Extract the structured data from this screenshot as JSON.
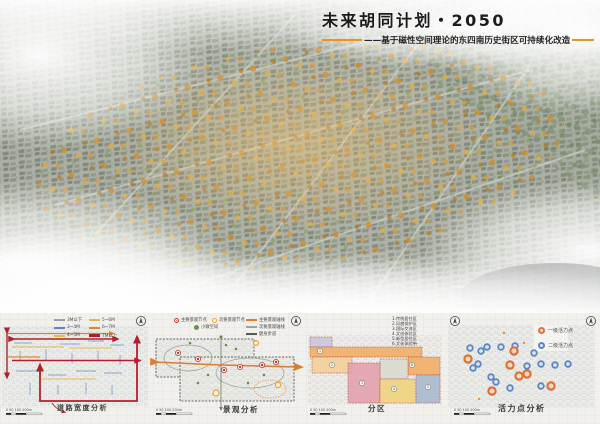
{
  "header": {
    "title": "未来胡同计划・2050",
    "subtitle": "——基于磁性空间理论的东四南历史街区可持续化改造",
    "accent_color": "#e8942c"
  },
  "aerial": {
    "caption": "鸟瞰图"
  },
  "icons": {
    "north_arrow": "north-arrow"
  },
  "panels": {
    "road": {
      "title": "道路宽度分析",
      "legend": [
        {
          "label": "3M以下",
          "color": "#9aa0a6"
        },
        {
          "label": "3~4M",
          "color": "#5b87c5"
        },
        {
          "label": "4~5M",
          "color": "#e4bd4e"
        },
        {
          "label": "5~6M",
          "color": "#f0b15c"
        },
        {
          "label": "6~7M",
          "color": "#e2842e"
        },
        {
          "label": "7M以上",
          "color": "#a32430"
        }
      ],
      "scale_label": "0 50 100   200m"
    },
    "landscape": {
      "title": "景观分析",
      "legend_points": [
        {
          "label": "主要景观节点",
          "color": "#c23b2e"
        },
        {
          "label": "次要景观节点",
          "color": "#e8a33d"
        },
        {
          "label": "小微空间",
          "color": "#6f8f4f"
        }
      ],
      "legend_lines": [
        {
          "label": "主要景观轴线",
          "color": "#e07b30"
        },
        {
          "label": "次要景观轴线",
          "color": "#9aa0a6"
        },
        {
          "label": "健身步道",
          "color": "#555a5e"
        }
      ],
      "scale_label": "0 50 100   200m"
    },
    "zoning": {
      "title": "分区",
      "legend": [
        {
          "label": "1.传统居住区",
          "color": "#efae66"
        },
        {
          "label": "2.风貌保护区",
          "color": "#f3cf9a"
        },
        {
          "label": "3.国际交流区",
          "color": "#e2a1ac"
        },
        {
          "label": "4.文创体验区",
          "color": "#eed37f"
        },
        {
          "label": "5.新型居住区",
          "color": "#a9b9cf"
        },
        {
          "label": "6.文化体验带",
          "color": "#c9c3d9"
        }
      ],
      "zone_markers": [
        "1",
        "2",
        "3",
        "4",
        "5",
        "6"
      ],
      "scale_label": "0 50 100   200m"
    },
    "vitality": {
      "title": "活力点分析",
      "legend": [
        {
          "label": "一级活力点",
          "color": "#e2703a"
        },
        {
          "label": "二级活力点",
          "color": "#5b87c5"
        }
      ],
      "scale_label": "0 50 100   200m"
    }
  }
}
